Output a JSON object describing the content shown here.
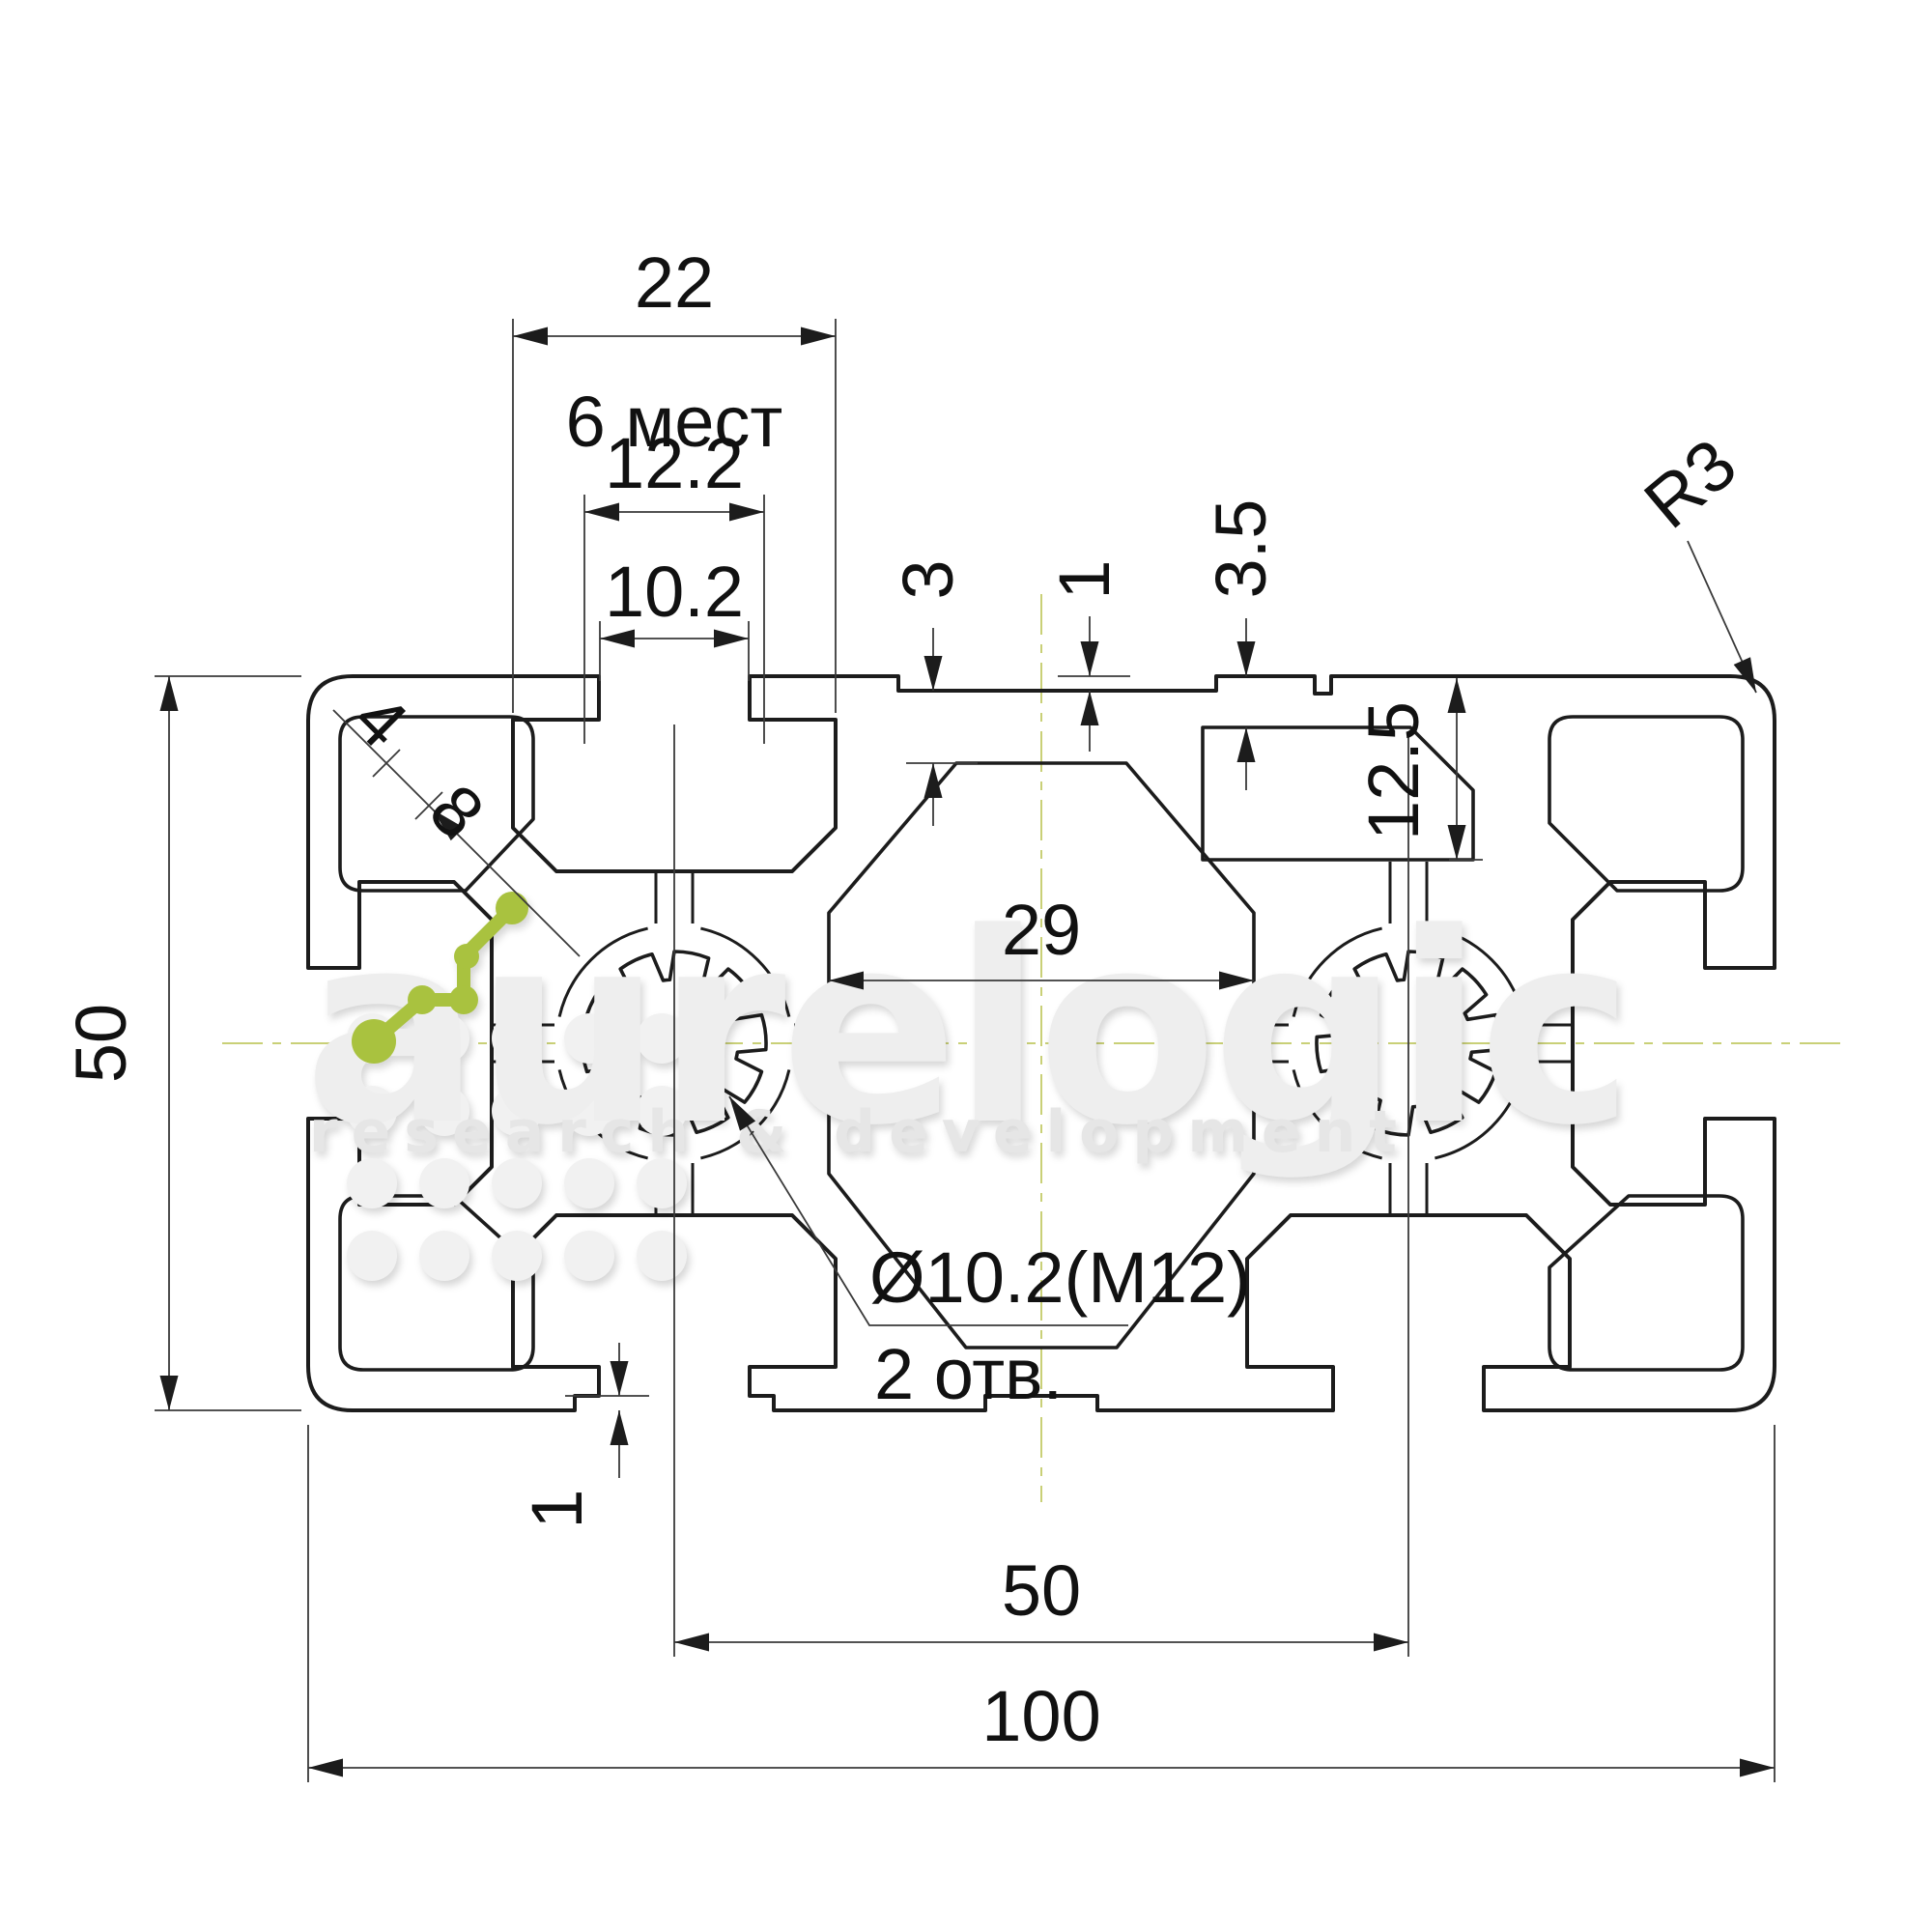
{
  "dimensions": {
    "top_slot_zone_width": "22",
    "places_note": "6 мест",
    "slot_cavity_width": "12.2",
    "slot_opening_width": "10.2",
    "wall_thickness": "3",
    "face_step": "1",
    "pad_height": "3.5",
    "pocket_depth": "12.5",
    "corner_radius": "R3",
    "diag_small": "4",
    "diag_large": "8",
    "profile_height": "50",
    "core_width": "29",
    "hole_callout": "Ø10.2(M12)",
    "hole_count": "2 отв.",
    "bottom_step": "1",
    "boss_spacing": "50",
    "profile_width": "100"
  },
  "watermark": {
    "brand": "aurelogic",
    "tagline": "research & development"
  },
  "colors": {
    "line": "#1c1c1c",
    "thin_line": "#3a3a3a",
    "centerline": "#c9d077",
    "logo_green": "#a9c23f",
    "watermark_gray": "#eeeeee"
  }
}
